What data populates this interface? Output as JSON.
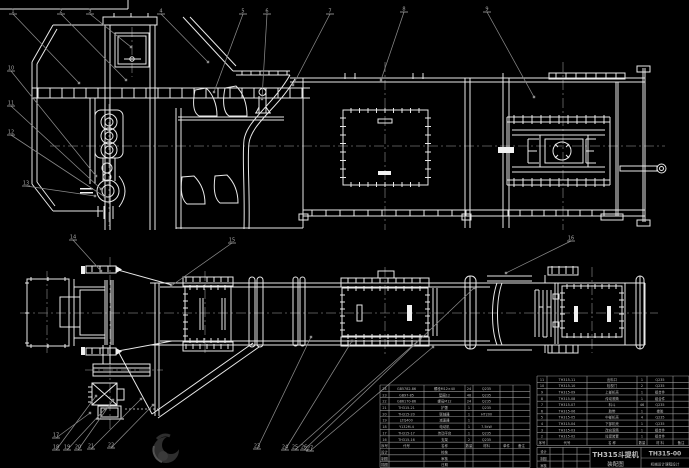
{
  "title_block": {
    "product": "TH315斗提机",
    "drawing_type": "装配图",
    "drawing_no": "TH315-00",
    "org": "机械设计课程设计"
  },
  "signature_labels": [
    "设计",
    "制图",
    "审核"
  ],
  "bom_header_right": [
    "序号",
    "代号",
    "名 称",
    "数量",
    "材 料",
    "备注"
  ],
  "bom_header_left": [
    "序号",
    "代号",
    "名称",
    "数量",
    "材料",
    "单件",
    "备注"
  ],
  "bom_right_rows": [
    [
      "11",
      "TH315-11",
      "出料口",
      "1",
      "Q235",
      ""
    ],
    [
      "10",
      "TH315-10",
      "检视门",
      "2",
      "Q235",
      ""
    ],
    [
      "9",
      "TH315-09",
      "上部机壳",
      "1",
      "组合件",
      ""
    ],
    [
      "8",
      "TH315-08",
      "传动滚筒",
      "1",
      "组合件",
      ""
    ],
    [
      "7",
      "TH315-07",
      "料斗",
      "46",
      "Q235",
      ""
    ],
    [
      "6",
      "TH315-06",
      "胶带",
      "1",
      "橡胶",
      ""
    ],
    [
      "5",
      "TH315-05",
      "中部机壳",
      "4",
      "Q235",
      ""
    ],
    [
      "4",
      "TH315-04",
      "下部机壳",
      "1",
      "Q235",
      ""
    ],
    [
      "3",
      "TH315-03",
      "改向滚筒",
      "1",
      "组合件",
      ""
    ],
    [
      "2",
      "TH315-02",
      "拉紧装置",
      "1",
      "组合件",
      ""
    ]
  ],
  "bom_left_rows": [
    [
      "24",
      "GB5782-86",
      "螺栓M12×40",
      "24",
      "Q235",
      "",
      ""
    ],
    [
      "23",
      "GB97-85",
      "垫圈12",
      "48",
      "Q235",
      "",
      ""
    ],
    [
      "22",
      "GB6170-86",
      "螺母M12",
      "24",
      "Q235",
      "",
      ""
    ],
    [
      "21",
      "TH315-21",
      "护罩",
      "1",
      "Q235",
      "",
      ""
    ],
    [
      "20",
      "TH315-20",
      "联轴器",
      "1",
      "HT200",
      "",
      ""
    ],
    [
      "19",
      "JZQ400",
      "减速器",
      "1",
      "",
      "",
      ""
    ],
    [
      "18",
      "Y132M-4",
      "电动机",
      "1",
      "7.5kW",
      "",
      ""
    ],
    [
      "17",
      "TH315-17",
      "传动平台",
      "1",
      "Q235",
      "",
      ""
    ],
    [
      "16",
      "TH315-16",
      "支架",
      "2",
      "Q235",
      "",
      ""
    ]
  ],
  "bom_left_bottom_rows": [
    [
      "设计",
      "",
      "校核",
      "",
      "",
      "",
      ""
    ],
    [
      "制图",
      "",
      "审核",
      "",
      "",
      "",
      ""
    ],
    [
      "描图",
      "",
      "日期",
      "",
      "",
      "",
      ""
    ]
  ],
  "balloon_numbers": [
    "1",
    "2",
    "3",
    "4",
    "5",
    "6",
    "7",
    "8",
    "9",
    "10",
    "11",
    "12",
    "13",
    "14",
    "15",
    "16",
    "17",
    "18",
    "19",
    "20",
    "21",
    "22",
    "23",
    "24",
    "25",
    "26",
    "27"
  ]
}
